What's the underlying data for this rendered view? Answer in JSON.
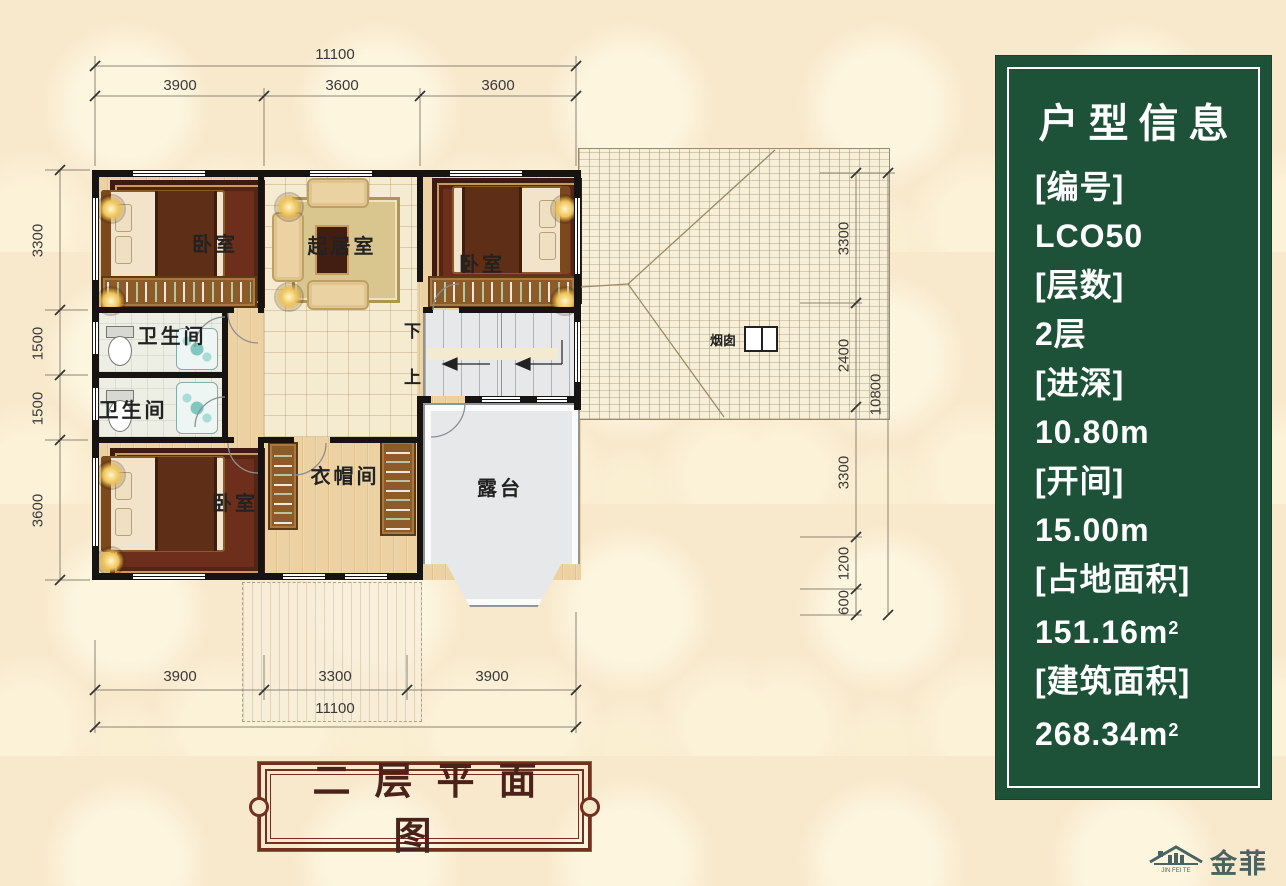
{
  "info_panel": {
    "title": "户型信息",
    "items": [
      {
        "label": "[编号]",
        "value": "LCO50"
      },
      {
        "label": "[层数]",
        "value": "2层"
      },
      {
        "label": "[进深]",
        "value": "10.80m"
      },
      {
        "label": "[开间]",
        "value": "15.00m"
      },
      {
        "label": "[占地面积]",
        "value": "151.16m",
        "sup": "2"
      },
      {
        "label": "[建筑面积]",
        "value": "268.34m",
        "sup": "2"
      }
    ]
  },
  "plan": {
    "caption": "二层平面图",
    "rooms": {
      "bedroom_tl": "卧室",
      "bedroom_tr": "卧室",
      "bedroom_bl": "卧室",
      "living": "起居室",
      "bath1": "卫生间",
      "bath2": "卫生间",
      "cloak": "衣帽间",
      "terrace": "露台",
      "chimney": "烟囱",
      "stair_down": "下",
      "stair_up": "上"
    }
  },
  "dimensions": {
    "top": {
      "total": "11100",
      "segments": [
        "3900",
        "3600",
        "3600"
      ]
    },
    "bottom": {
      "total": "11100",
      "segments": [
        "3900",
        "3300",
        "3900"
      ]
    },
    "left": {
      "segments": [
        "3300",
        "1500",
        "1500",
        "3600"
      ]
    },
    "right": {
      "total": "10800",
      "segments": [
        "3300",
        "2400",
        "3300",
        "1200",
        "600"
      ]
    }
  },
  "logo": {
    "name": "金菲特",
    "sub": "JIN FEI TE"
  },
  "colors": {
    "panel_green": "#1d5138",
    "banner_brown": "#73301f",
    "background_cream": "#f8e9cd"
  }
}
